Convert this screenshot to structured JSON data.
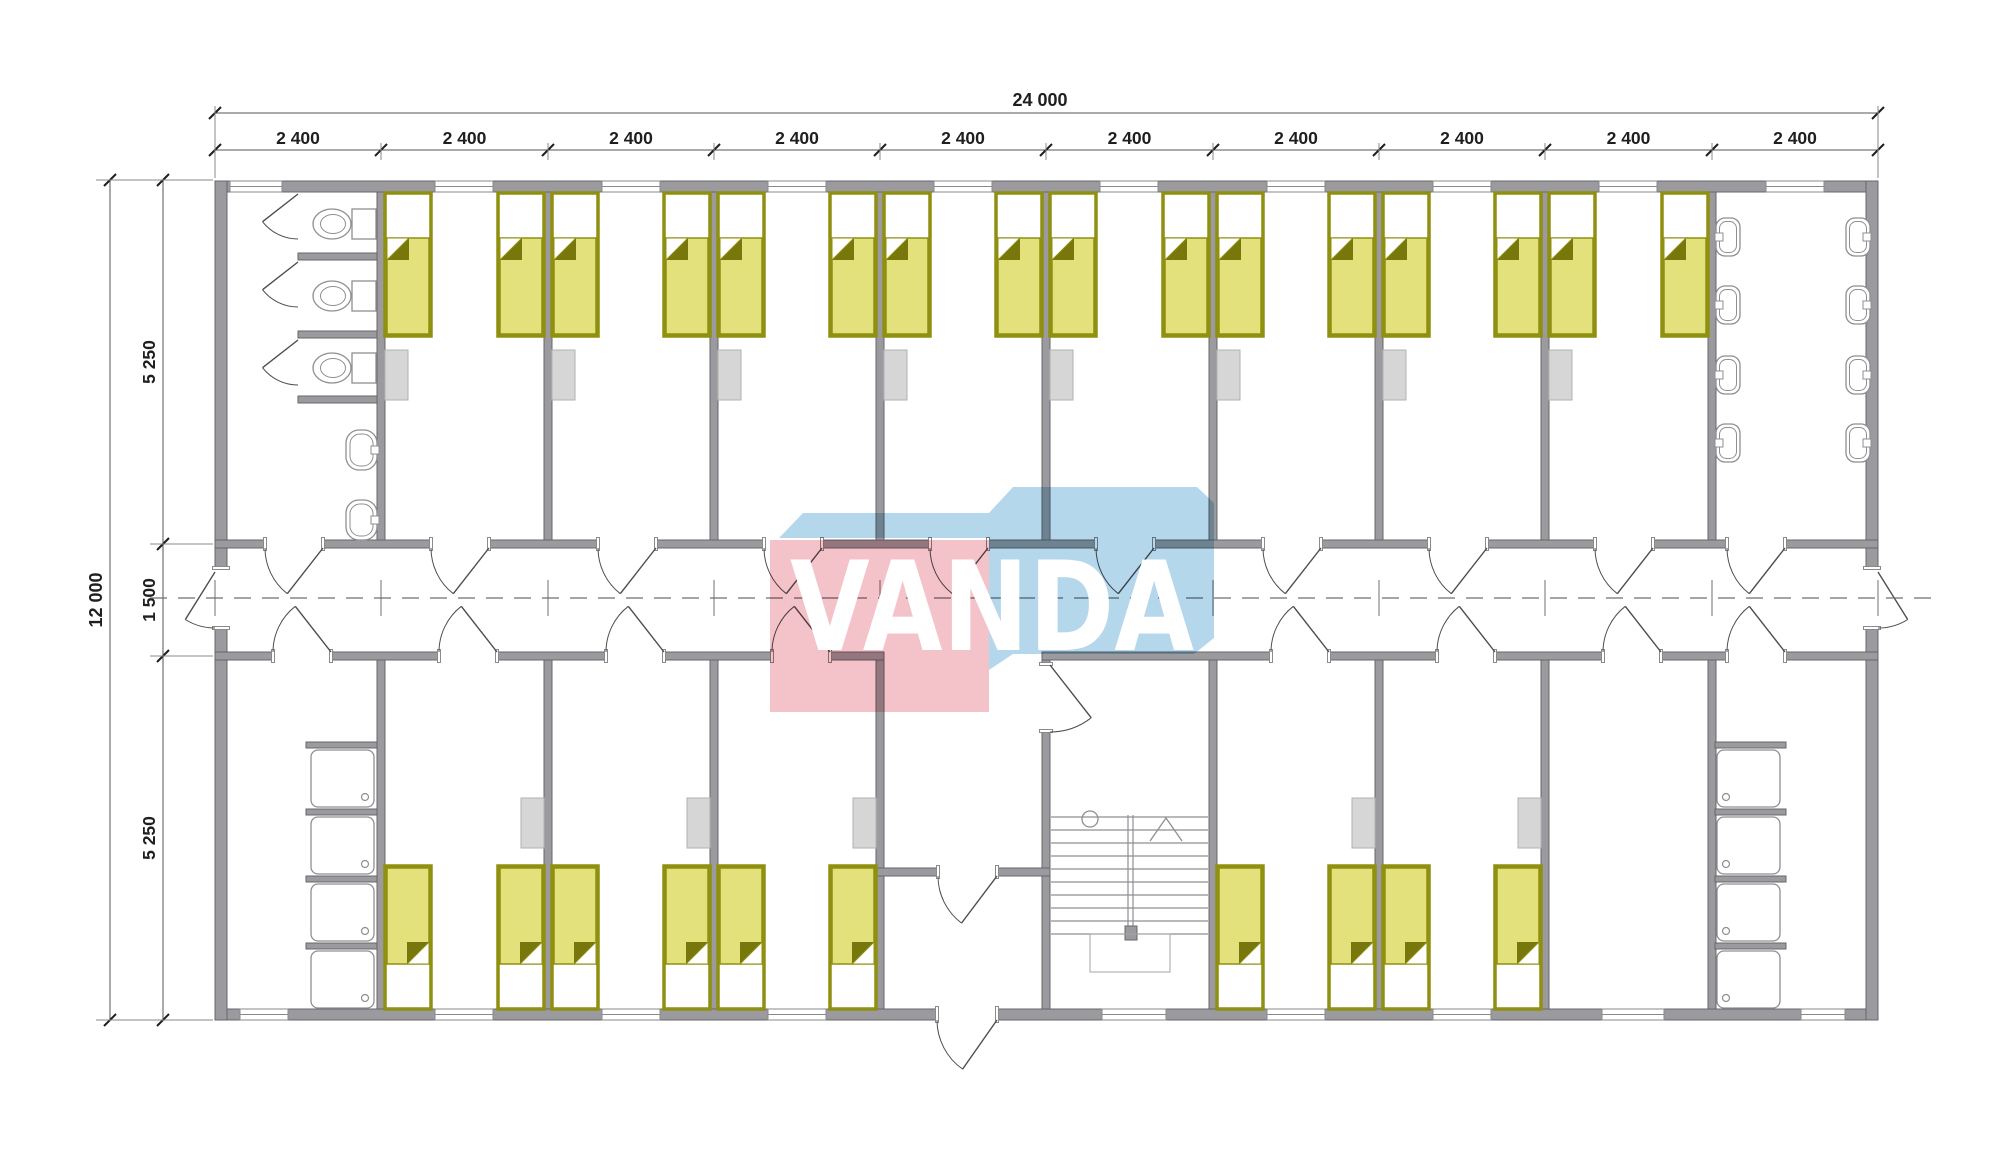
{
  "title": "VANDA modular dormitory floor plan",
  "canvas": {
    "w": 2000,
    "h": 1175,
    "bg": "#ffffff"
  },
  "colors": {
    "wall": "#9b9b9f",
    "wall_stroke": "#67676b",
    "fixture_stroke": "#8f8f93",
    "furniture": "#d6d6d6",
    "furniture_stroke": "#b2b2b2",
    "bed_frame": "#8f8f10",
    "bed_blanket": "#e2e17b",
    "bed_fold": "#77770c",
    "pillow": "#ffffff",
    "door": "#4d4d4d",
    "centerline": "#6f6f6f",
    "stair": "#8f8f93",
    "dim": "#1f1f1f",
    "wm_blue": "#b5d7eb",
    "wm_pink": "#f4c3ca",
    "wm_text": "#ffffff"
  },
  "watermark": {
    "text": "VANDA",
    "pink_poly": [
      [
        770,
        540
      ],
      [
        989,
        540
      ],
      [
        989,
        712
      ],
      [
        770,
        712
      ]
    ],
    "blue_poly": [
      [
        779,
        538
      ],
      [
        803,
        513
      ],
      [
        989,
        513
      ],
      [
        1013,
        487
      ],
      [
        1197,
        487
      ],
      [
        1214,
        503
      ],
      [
        1214,
        638
      ],
      [
        1194,
        654
      ],
      [
        1013,
        654
      ],
      [
        989,
        670
      ],
      [
        989,
        538
      ]
    ],
    "text_box": {
      "x": 790,
      "y": 650,
      "size": 124,
      "length": 404
    }
  },
  "dimensions": {
    "top_overall": {
      "label": "24 000",
      "line_y": 113,
      "label_y": 106,
      "label_x": 1040
    },
    "top_modules": {
      "labels": [
        "2 400",
        "2 400",
        "2 400",
        "2 400",
        "2 400",
        "2 400",
        "2 400",
        "2 400",
        "2 400",
        "2 400"
      ],
      "line_y": 150,
      "label_y": 144
    },
    "left_overall": {
      "label": "12 000",
      "line_x": 110,
      "label_x": 102
    },
    "left_segments": {
      "labels": [
        "5 250",
        "1 500",
        "5 250"
      ],
      "line_x": 163,
      "label_x": 155,
      "ticks_y": [
        180,
        544,
        656,
        1020
      ],
      "centers_y": [
        362,
        600,
        838
      ]
    }
  },
  "geometry": {
    "modules_x": [
      215,
      381,
      548,
      714,
      880,
      1046,
      1213,
      1379,
      1545,
      1712,
      1878
    ],
    "ext_walls": [
      [
        215,
        181,
        1663,
        11
      ],
      [
        215,
        1009,
        1663,
        11
      ],
      [
        215,
        181,
        12,
        839
      ],
      [
        1866,
        181,
        12,
        839
      ]
    ],
    "corridor": {
      "top_wall": [
        215,
        540,
        1663,
        8
      ],
      "bottom_walls": [
        [
          215,
          652,
          669,
          8
        ],
        [
          1042,
          652,
          836,
          8
        ]
      ],
      "centerline_y": 598,
      "centerline_x": [
        150,
        1942
      ]
    },
    "inner_walls_top": {
      "y": 192,
      "h": 348,
      "xs": [
        381,
        548,
        714,
        880,
        1046,
        1213,
        1379,
        1545,
        1712
      ]
    },
    "inner_walls_bottom": {
      "y": 660,
      "h": 349,
      "xs": [
        381,
        548,
        714,
        880,
        1046,
        1213,
        1379,
        1545,
        1712
      ]
    },
    "hall_wall": [
      877,
      868,
      173,
      8
    ],
    "toilet_partitions": [
      [
        298,
        253,
        79,
        7
      ],
      [
        298,
        331,
        79,
        7
      ],
      [
        298,
        396,
        79,
        7
      ]
    ],
    "shower_partitions": [
      [
        306,
        742,
        71,
        6
      ],
      [
        306,
        809,
        71,
        6
      ],
      [
        306,
        876,
        71,
        6
      ],
      [
        306,
        943,
        71,
        6
      ],
      [
        1715,
        742,
        71,
        6
      ],
      [
        1715,
        809,
        71,
        6
      ],
      [
        1715,
        876,
        71,
        6
      ],
      [
        1715,
        943,
        71,
        6
      ]
    ],
    "windows_top": [
      [
        230,
        282
      ],
      [
        435,
        493
      ],
      [
        602,
        660
      ],
      [
        768,
        826
      ],
      [
        934,
        992
      ],
      [
        1100,
        1158
      ],
      [
        1267,
        1325
      ],
      [
        1433,
        1491
      ],
      [
        1599,
        1657
      ],
      [
        1766,
        1824
      ]
    ],
    "windows_bottom": [
      [
        240,
        288
      ],
      [
        435,
        493
      ],
      [
        602,
        660
      ],
      [
        768,
        826
      ],
      [
        1102,
        1166
      ],
      [
        1267,
        1325
      ],
      [
        1433,
        1491
      ],
      [
        1602,
        1664
      ],
      [
        1801,
        1845
      ]
    ],
    "openings_top_wall": [
      [
        265,
        323
      ],
      [
        431,
        489
      ],
      [
        598,
        656
      ],
      [
        764,
        822
      ],
      [
        930,
        988
      ],
      [
        1096,
        1154
      ],
      [
        1263,
        1321
      ],
      [
        1429,
        1487
      ],
      [
        1595,
        1653
      ],
      [
        1727,
        1785
      ]
    ],
    "openings_bottom_wall": [
      [
        273,
        331
      ],
      [
        439,
        497
      ],
      [
        606,
        664
      ],
      [
        772,
        830
      ],
      [
        1271,
        1329
      ],
      [
        1437,
        1495
      ],
      [
        1603,
        1661
      ],
      [
        1727,
        1785
      ]
    ],
    "opening_hall": [
      938,
      997
    ],
    "opening_entrance": [
      937,
      997
    ],
    "opening_exit_left": [
      568,
      628
    ],
    "opening_exit_right": [
      568,
      628
    ],
    "opening_stair": [
      664,
      731
    ],
    "doors": [
      {
        "name": "room-door",
        "h": [
          323,
          548
        ],
        "r": 58,
        "a0": 180,
        "a1": 128
      },
      {
        "name": "room-door",
        "h": [
          489,
          548
        ],
        "r": 58,
        "a0": 180,
        "a1": 128
      },
      {
        "name": "room-door",
        "h": [
          656,
          548
        ],
        "r": 58,
        "a0": 180,
        "a1": 128
      },
      {
        "name": "room-door",
        "h": [
          822,
          548
        ],
        "r": 58,
        "a0": 180,
        "a1": 128
      },
      {
        "name": "room-door",
        "h": [
          988,
          548
        ],
        "r": 58,
        "a0": 180,
        "a1": 128
      },
      {
        "name": "room-door",
        "h": [
          1154,
          548
        ],
        "r": 58,
        "a0": 180,
        "a1": 128
      },
      {
        "name": "room-door",
        "h": [
          1321,
          548
        ],
        "r": 58,
        "a0": 180,
        "a1": 128
      },
      {
        "name": "room-door",
        "h": [
          1487,
          548
        ],
        "r": 58,
        "a0": 180,
        "a1": 128
      },
      {
        "name": "room-door",
        "h": [
          1653,
          548
        ],
        "r": 58,
        "a0": 180,
        "a1": 128
      },
      {
        "name": "washroom-door",
        "h": [
          1785,
          548
        ],
        "r": 58,
        "a0": 180,
        "a1": 128
      },
      {
        "name": "room-door",
        "h": [
          331,
          652
        ],
        "r": 58,
        "a0": 180,
        "a1": 232
      },
      {
        "name": "room-door",
        "h": [
          497,
          652
        ],
        "r": 58,
        "a0": 180,
        "a1": 232
      },
      {
        "name": "room-door",
        "h": [
          664,
          652
        ],
        "r": 58,
        "a0": 180,
        "a1": 232
      },
      {
        "name": "room-door",
        "h": [
          830,
          652
        ],
        "r": 58,
        "a0": 180,
        "a1": 232
      },
      {
        "name": "room-door",
        "h": [
          1329,
          652
        ],
        "r": 58,
        "a0": 180,
        "a1": 232
      },
      {
        "name": "room-door",
        "h": [
          1495,
          652
        ],
        "r": 58,
        "a0": 180,
        "a1": 232
      },
      {
        "name": "room-door",
        "h": [
          1661,
          652
        ],
        "r": 58,
        "a0": 180,
        "a1": 232
      },
      {
        "name": "shower-door",
        "h": [
          1785,
          652
        ],
        "r": 58,
        "a0": 180,
        "a1": 232
      },
      {
        "name": "exit-door-left",
        "h": [
          215,
          572
        ],
        "r": 56,
        "a0": 90,
        "a1": 122
      },
      {
        "name": "exit-door-right",
        "h": [
          1878,
          572
        ],
        "r": 56,
        "a0": 90,
        "a1": 58
      },
      {
        "name": "entrance-door",
        "h": [
          997,
          1020
        ],
        "r": 60,
        "a0": 180,
        "a1": 125
      },
      {
        "name": "vestibule-door",
        "h": [
          997,
          876
        ],
        "r": 59,
        "a0": 180,
        "a1": 127
      },
      {
        "name": "stair-door",
        "h": [
          1050,
          665
        ],
        "r": 67,
        "a0": 90,
        "a1": 52
      },
      {
        "name": "toilet-stall-door",
        "h": [
          298,
          194
        ],
        "r": 45,
        "a0": 90,
        "a1": 142
      },
      {
        "name": "toilet-stall-door",
        "h": [
          298,
          262
        ],
        "r": 45,
        "a0": 90,
        "a1": 142
      },
      {
        "name": "toilet-stall-door",
        "h": [
          298,
          340
        ],
        "r": 45,
        "a0": 90,
        "a1": 142
      }
    ],
    "beds_top": {
      "y": 193,
      "w": 46,
      "h": 143,
      "xs": [
        385,
        498,
        552,
        664,
        718,
        830,
        884,
        996,
        1050,
        1163,
        1217,
        1329,
        1383,
        1495,
        1549,
        1662
      ]
    },
    "beds_bottom": {
      "y": 866,
      "w": 46,
      "h": 143,
      "xs": [
        385,
        498,
        552,
        664,
        718,
        830,
        1217,
        1329,
        1383,
        1495
      ]
    },
    "nightstands_top": {
      "y": 350,
      "w": 23,
      "h": 50,
      "xs": [
        385,
        552,
        718,
        884,
        1050,
        1217,
        1383,
        1549
      ]
    },
    "nightstands_bottom": {
      "y": 798,
      "w": 23,
      "h": 50,
      "xs": [
        521,
        687,
        853,
        1352,
        1518
      ]
    },
    "toilets_cy": [
      224,
      296,
      368
    ],
    "wall_sinks_y": [
      430,
      500
    ],
    "basins": {
      "ys": [
        218,
        286,
        356,
        424
      ],
      "left_x": 1716,
      "right_x": 1846
    },
    "showers": {
      "ys": [
        750,
        817,
        884,
        951
      ],
      "left_x": 311,
      "right_x": 1717,
      "w": 63,
      "h": 57
    },
    "stairs": {
      "x1": 1051,
      "x2": 1208,
      "tread_y0": 817,
      "tread_step": 13,
      "tread_count": 10,
      "stringer_x": [
        1128,
        1133
      ],
      "stringer_y": [
        815,
        938
      ],
      "foot": [
        1125,
        926,
        12,
        14
      ],
      "circle": [
        1090,
        819,
        8
      ],
      "arrow": [
        [
          1150,
          841
        ],
        [
          1166,
          818
        ],
        [
          1182,
          841
        ]
      ],
      "subrect": [
        1090,
        934,
        80,
        38
      ]
    }
  },
  "inventory": {
    "beds": 26,
    "toilet_stalls": 3,
    "toilet_room_sinks": 2,
    "washbasins": 8,
    "showers": 8,
    "stairs": 1
  }
}
